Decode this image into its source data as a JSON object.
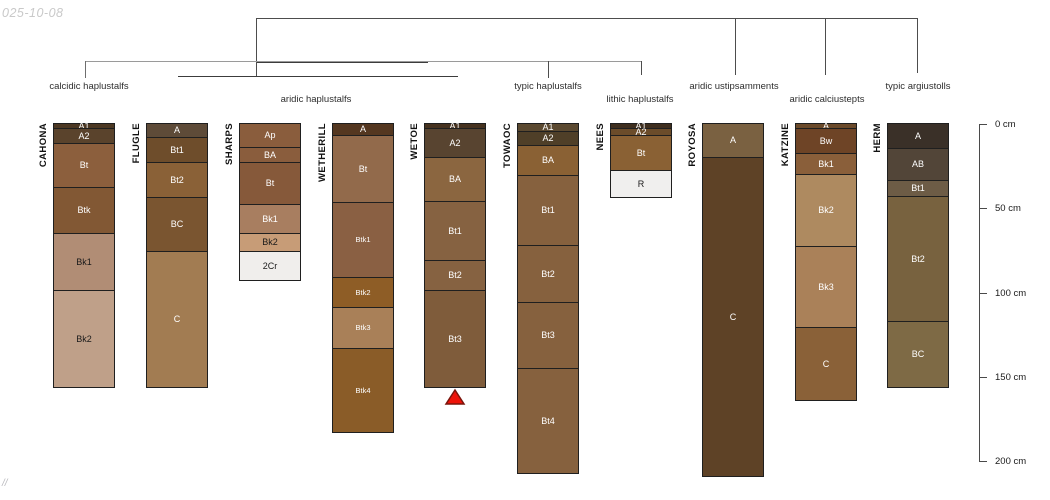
{
  "page": {
    "date_label": "025-10-08",
    "footer_label": "//",
    "background": "#ffffff"
  },
  "chart_data": {
    "type": "table",
    "subtype": "soil-profile-sketches-with-dendrogram",
    "title": "",
    "depth_axis": {
      "unit": "cm",
      "ticks": [
        {
          "cm": 0,
          "label": "0 cm"
        },
        {
          "cm": 50,
          "label": "50 cm"
        },
        {
          "cm": 100,
          "label": "100 cm"
        },
        {
          "cm": 150,
          "label": "150 cm"
        },
        {
          "cm": 200,
          "label": "200 cm"
        }
      ],
      "axis_x": 979,
      "top_y": 124,
      "px_per_cm": 1.685,
      "tick_len": 8,
      "label_x": 995
    },
    "classification_labels": [
      {
        "text": "calcidic haplustalfs",
        "x": 89,
        "y": 86
      },
      {
        "text": "aridic haplustalfs",
        "x": 316,
        "y": 99
      },
      {
        "text": "typic haplustalfs",
        "x": 548,
        "y": 86
      },
      {
        "text": "lithic haplustalfs",
        "x": 640,
        "y": 99
      },
      {
        "text": "aridic ustipsamments",
        "x": 734,
        "y": 86
      },
      {
        "text": "aridic calciustepts",
        "x": 827,
        "y": 99
      },
      {
        "text": "typic argiustolls",
        "x": 918,
        "y": 86
      }
    ],
    "dendrogram_segments": [
      {
        "x1": 256,
        "y1": 18,
        "x2": 917,
        "y2": 18,
        "color": "#4d4d4d"
      },
      {
        "x1": 256,
        "y1": 18,
        "x2": 256,
        "y2": 76,
        "color": "#4d4d4d"
      },
      {
        "x1": 735,
        "y1": 18,
        "x2": 735,
        "y2": 74,
        "color": "#4d4d4d"
      },
      {
        "x1": 825,
        "y1": 18,
        "x2": 825,
        "y2": 74,
        "color": "#4d4d4d"
      },
      {
        "x1": 917,
        "y1": 18,
        "x2": 917,
        "y2": 72,
        "color": "#4d4d4d"
      },
      {
        "x1": 85,
        "y1": 61,
        "x2": 641,
        "y2": 61,
        "color": "#9a9a9a"
      },
      {
        "x1": 257,
        "y1": 62,
        "x2": 427,
        "y2": 62,
        "color": "#3c3c3c"
      },
      {
        "x1": 85,
        "y1": 61,
        "x2": 85,
        "y2": 77,
        "color": "#6e6e6e"
      },
      {
        "x1": 548,
        "y1": 61,
        "x2": 548,
        "y2": 77,
        "color": "#4d4d4d"
      },
      {
        "x1": 641,
        "y1": 61,
        "x2": 641,
        "y2": 74,
        "color": "#4d4d4d"
      },
      {
        "x1": 178,
        "y1": 76,
        "x2": 457,
        "y2": 76,
        "color": "#3c3c3c"
      }
    ],
    "layout": {
      "top_px": 123,
      "px_per_cm": 1.69,
      "column_width": 62,
      "name_offset": 15
    },
    "profiles": [
      {
        "name": "CAHONA",
        "x": 53,
        "taxon": "calcidic haplustalfs",
        "horizons": [
          {
            "label": "A1",
            "top_cm": 0,
            "bottom_cm": 3,
            "color": "#4c3823",
            "text": "#ffffff"
          },
          {
            "label": "A2",
            "top_cm": 3,
            "bottom_cm": 12,
            "color": "#5a432c",
            "text": "#ffffff"
          },
          {
            "label": "Bt",
            "top_cm": 12,
            "bottom_cm": 38,
            "color": "#8c5f3d",
            "text": "#ffffff"
          },
          {
            "label": "Btk",
            "top_cm": 38,
            "bottom_cm": 65,
            "color": "#825834",
            "text": "#ffffff"
          },
          {
            "label": "Bk1",
            "top_cm": 65,
            "bottom_cm": 99,
            "color": "#b18d75",
            "text": "#1a1a1a"
          },
          {
            "label": "Bk2",
            "top_cm": 99,
            "bottom_cm": 156,
            "color": "#bfa089",
            "text": "#1a1a1a"
          }
        ]
      },
      {
        "name": "FLUGLE",
        "x": 146,
        "taxon": "aridic haplustalfs",
        "horizons": [
          {
            "label": "A",
            "top_cm": 0,
            "bottom_cm": 8,
            "color": "#5e4b38",
            "text": "#ffffff"
          },
          {
            "label": "Bt1",
            "top_cm": 8,
            "bottom_cm": 23,
            "color": "#6e4d2b",
            "text": "#ffffff"
          },
          {
            "label": "Bt2",
            "top_cm": 23,
            "bottom_cm": 44,
            "color": "#8a6137",
            "text": "#ffffff"
          },
          {
            "label": "BC",
            "top_cm": 44,
            "bottom_cm": 76,
            "color": "#7a5530",
            "text": "#ffffff"
          },
          {
            "label": "C",
            "top_cm": 76,
            "bottom_cm": 156,
            "color": "#a27c52",
            "text": "#ffffff"
          }
        ]
      },
      {
        "name": "SHARPS",
        "x": 239,
        "taxon": "aridic haplustalfs",
        "horizons": [
          {
            "label": "Ap",
            "top_cm": 0,
            "bottom_cm": 14,
            "color": "#8a5d3d",
            "text": "#ffffff"
          },
          {
            "label": "BA",
            "top_cm": 14,
            "bottom_cm": 23,
            "color": "#8a5d3d",
            "text": "#ffffff"
          },
          {
            "label": "Bt",
            "top_cm": 23,
            "bottom_cm": 48,
            "color": "#86593a",
            "text": "#ffffff"
          },
          {
            "label": "Bk1",
            "top_cm": 48,
            "bottom_cm": 65,
            "color": "#a87e60",
            "text": "#ffffff"
          },
          {
            "label": "Bk2",
            "top_cm": 65,
            "bottom_cm": 76,
            "color": "#c79c77",
            "text": "#1a1a1a"
          },
          {
            "label": "2Cr",
            "top_cm": 76,
            "bottom_cm": 93,
            "color": "#f0eeec",
            "text": "#1a1a1a"
          }
        ]
      },
      {
        "name": "WETHERILL",
        "x": 332,
        "taxon": "aridic haplustalfs",
        "horizons": [
          {
            "label": "A",
            "top_cm": 0,
            "bottom_cm": 7,
            "color": "#543720",
            "text": "#ffffff"
          },
          {
            "label": "Bt",
            "top_cm": 7,
            "bottom_cm": 47,
            "color": "#926a4b",
            "text": "#ffffff"
          },
          {
            "label": "Btk1",
            "top_cm": 47,
            "bottom_cm": 91,
            "color": "#8a6043",
            "text": "#ffffff",
            "small": true
          },
          {
            "label": "Btk2",
            "top_cm": 91,
            "bottom_cm": 109,
            "color": "#8e5d26",
            "text": "#ffffff",
            "small": true
          },
          {
            "label": "Btk3",
            "top_cm": 109,
            "bottom_cm": 133,
            "color": "#a98058",
            "text": "#ffffff",
            "small": true
          },
          {
            "label": "Btk4",
            "top_cm": 133,
            "bottom_cm": 183,
            "color": "#8a5c28",
            "text": "#ffffff",
            "small": true
          }
        ]
      },
      {
        "name": "WETOE",
        "x": 424,
        "taxon": "aridic haplustalfs",
        "horizons": [
          {
            "label": "A1",
            "top_cm": 0,
            "bottom_cm": 3,
            "color": "#46321f",
            "text": "#ffffff"
          },
          {
            "label": "A2",
            "top_cm": 3,
            "bottom_cm": 20,
            "color": "#584430",
            "text": "#ffffff"
          },
          {
            "label": "BA",
            "top_cm": 20,
            "bottom_cm": 46,
            "color": "#8b6640",
            "text": "#ffffff"
          },
          {
            "label": "Bt1",
            "top_cm": 46,
            "bottom_cm": 81,
            "color": "#866241",
            "text": "#ffffff"
          },
          {
            "label": "Bt2",
            "top_cm": 81,
            "bottom_cm": 99,
            "color": "#866241",
            "text": "#ffffff"
          },
          {
            "label": "Bt3",
            "top_cm": 99,
            "bottom_cm": 156,
            "color": "#7f5c3b",
            "text": "#ffffff"
          }
        ]
      },
      {
        "name": "TOWAOC",
        "x": 517,
        "taxon": "typic haplustalfs",
        "horizons": [
          {
            "label": "A1",
            "top_cm": 0,
            "bottom_cm": 5,
            "color": "#5b4930",
            "text": "#ffffff"
          },
          {
            "label": "A2",
            "top_cm": 5,
            "bottom_cm": 13,
            "color": "#4f3f28",
            "text": "#ffffff"
          },
          {
            "label": "BA",
            "top_cm": 13,
            "bottom_cm": 31,
            "color": "#8a6134",
            "text": "#ffffff"
          },
          {
            "label": "Bt1",
            "top_cm": 31,
            "bottom_cm": 72,
            "color": "#86613e",
            "text": "#ffffff"
          },
          {
            "label": "Bt2",
            "top_cm": 72,
            "bottom_cm": 106,
            "color": "#86613e",
            "text": "#ffffff"
          },
          {
            "label": "Bt3",
            "top_cm": 106,
            "bottom_cm": 145,
            "color": "#86613e",
            "text": "#ffffff"
          },
          {
            "label": "Bt4",
            "top_cm": 145,
            "bottom_cm": 207,
            "color": "#86613e",
            "text": "#ffffff"
          }
        ]
      },
      {
        "name": "NEES",
        "x": 610,
        "taxon": "lithic haplustalfs",
        "horizons": [
          {
            "label": "A1",
            "top_cm": 0,
            "bottom_cm": 3,
            "color": "#3e2e1e",
            "text": "#ffffff"
          },
          {
            "label": "A2",
            "top_cm": 3,
            "bottom_cm": 7,
            "color": "#6b4c2a",
            "text": "#ffffff"
          },
          {
            "label": "Bt",
            "top_cm": 7,
            "bottom_cm": 28,
            "color": "#8a6134",
            "text": "#ffffff"
          },
          {
            "label": "R",
            "top_cm": 28,
            "bottom_cm": 44,
            "color": "#f0efee",
            "text": "#1a1a1a"
          }
        ]
      },
      {
        "name": "ROYOSA",
        "x": 702,
        "taxon": "aridic ustipsamments",
        "horizons": [
          {
            "label": "A",
            "top_cm": 0,
            "bottom_cm": 20,
            "color": "#7a6141",
            "text": "#ffffff"
          },
          {
            "label": "C",
            "top_cm": 20,
            "bottom_cm": 209,
            "color": "#5e4226",
            "text": "#ffffff"
          }
        ]
      },
      {
        "name": "KATZINE",
        "x": 795,
        "taxon": "aridic calciustepts",
        "horizons": [
          {
            "label": "A",
            "top_cm": 0,
            "bottom_cm": 3,
            "color": "#6b4a2a",
            "text": "#ffffff"
          },
          {
            "label": "Bw",
            "top_cm": 3,
            "bottom_cm": 18,
            "color": "#6e4426",
            "text": "#ffffff"
          },
          {
            "label": "Bk1",
            "top_cm": 18,
            "bottom_cm": 30,
            "color": "#8a5f3a",
            "text": "#ffffff"
          },
          {
            "label": "Bk2",
            "top_cm": 30,
            "bottom_cm": 73,
            "color": "#ae8a60",
            "text": "#ffffff"
          },
          {
            "label": "Bk3",
            "top_cm": 73,
            "bottom_cm": 121,
            "color": "#aa8159",
            "text": "#ffffff"
          },
          {
            "label": "C",
            "top_cm": 121,
            "bottom_cm": 164,
            "color": "#8a6138",
            "text": "#ffffff"
          }
        ]
      },
      {
        "name": "HERM",
        "x": 887,
        "taxon": "typic argiustolls",
        "horizons": [
          {
            "label": "A",
            "top_cm": 0,
            "bottom_cm": 15,
            "color": "#3a3028",
            "text": "#ffffff"
          },
          {
            "label": "AB",
            "top_cm": 15,
            "bottom_cm": 34,
            "color": "#524538",
            "text": "#ffffff"
          },
          {
            "label": "Bt1",
            "top_cm": 34,
            "bottom_cm": 43,
            "color": "#6d5c46",
            "text": "#ffffff"
          },
          {
            "label": "Bt2",
            "top_cm": 43,
            "bottom_cm": 117,
            "color": "#78623f",
            "text": "#ffffff"
          },
          {
            "label": "BC",
            "top_cm": 117,
            "bottom_cm": 156,
            "color": "#7e6a45",
            "text": "#ffffff"
          }
        ]
      }
    ],
    "marker": {
      "shape": "triangle",
      "under_column": "WETOE",
      "x": 455,
      "y": 389,
      "width": 18,
      "height": 14,
      "fill": "#ee1208",
      "stroke": "#7a150c"
    }
  }
}
